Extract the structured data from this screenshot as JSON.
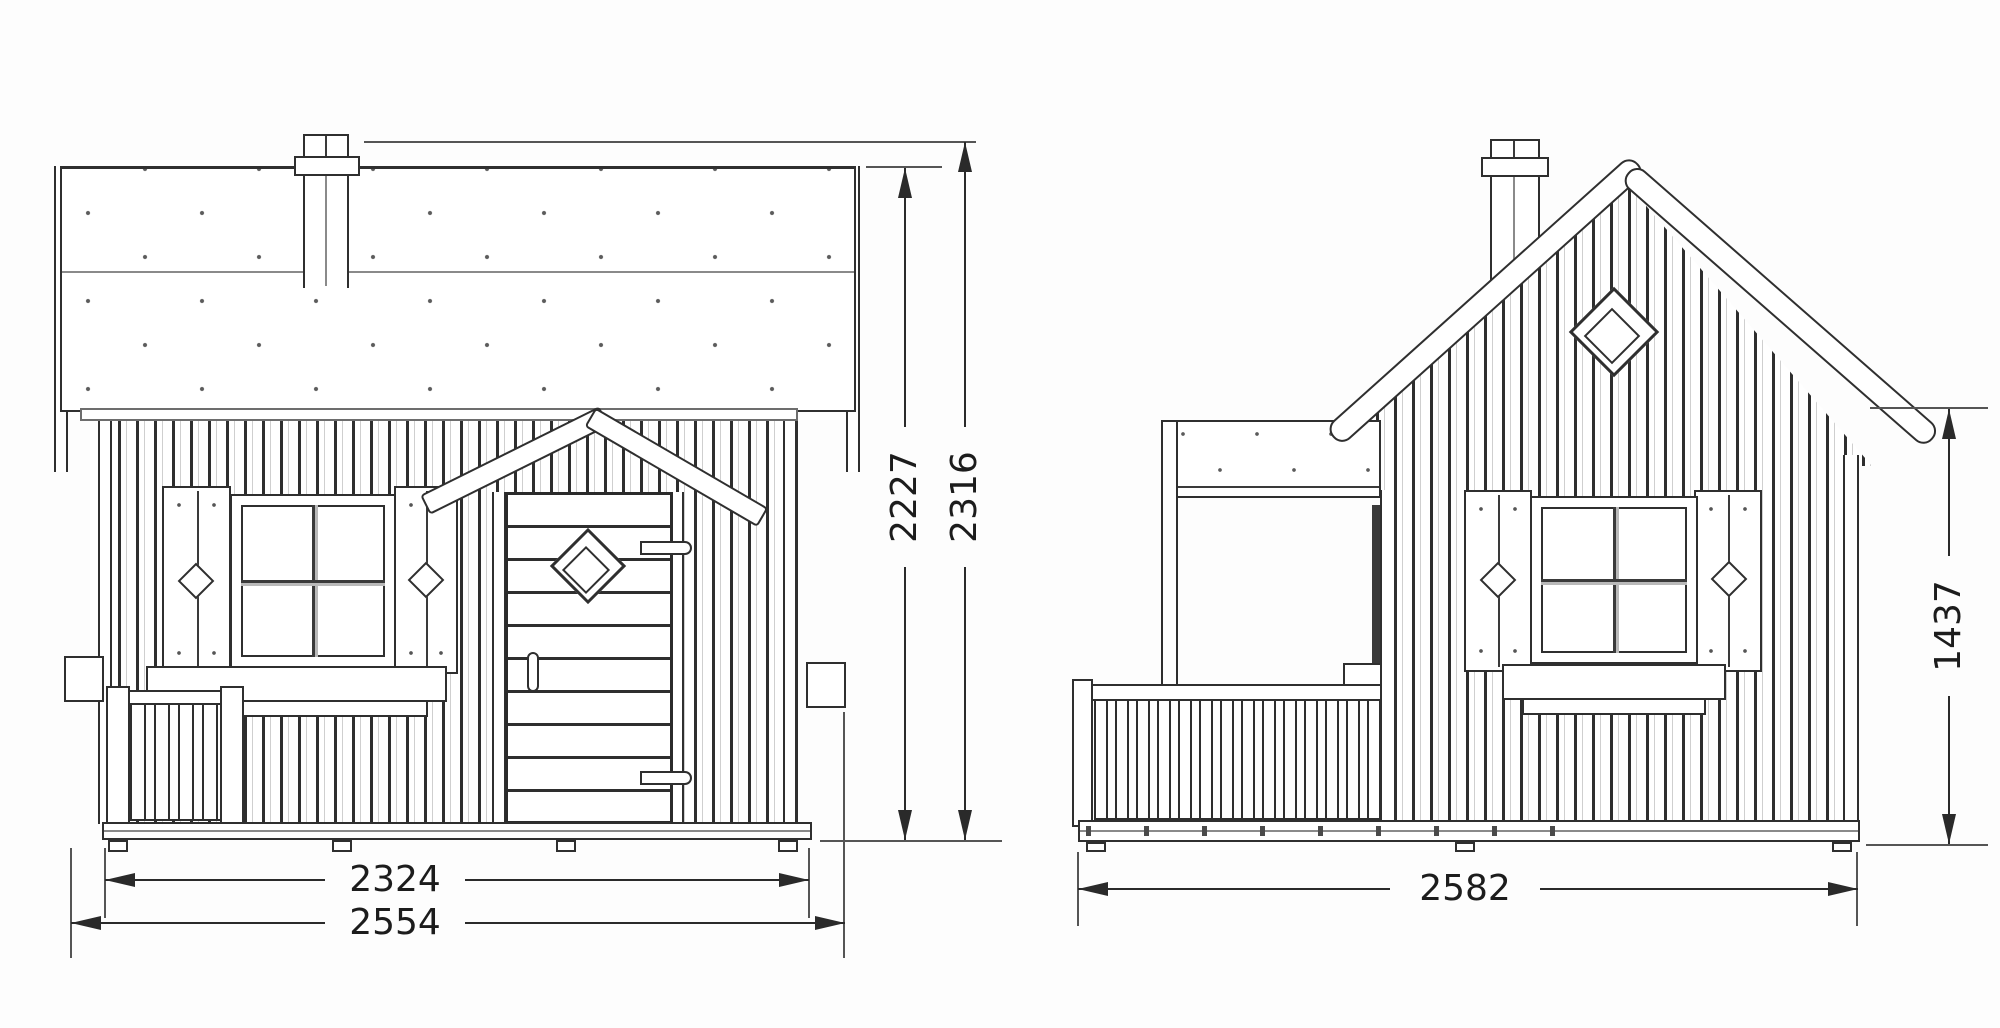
{
  "drawing": {
    "background": "#fdfdfd",
    "line_color": "#2f2f2f",
    "dimension_color": "#2a2a2a",
    "front_view": {
      "dim_base_width": "2324",
      "dim_overall_width": "2554",
      "dim_wall_roof_height": "2227",
      "dim_overall_height": "2316"
    },
    "side_view": {
      "dim_overall_depth": "2582",
      "dim_eave_height": "1437"
    }
  }
}
